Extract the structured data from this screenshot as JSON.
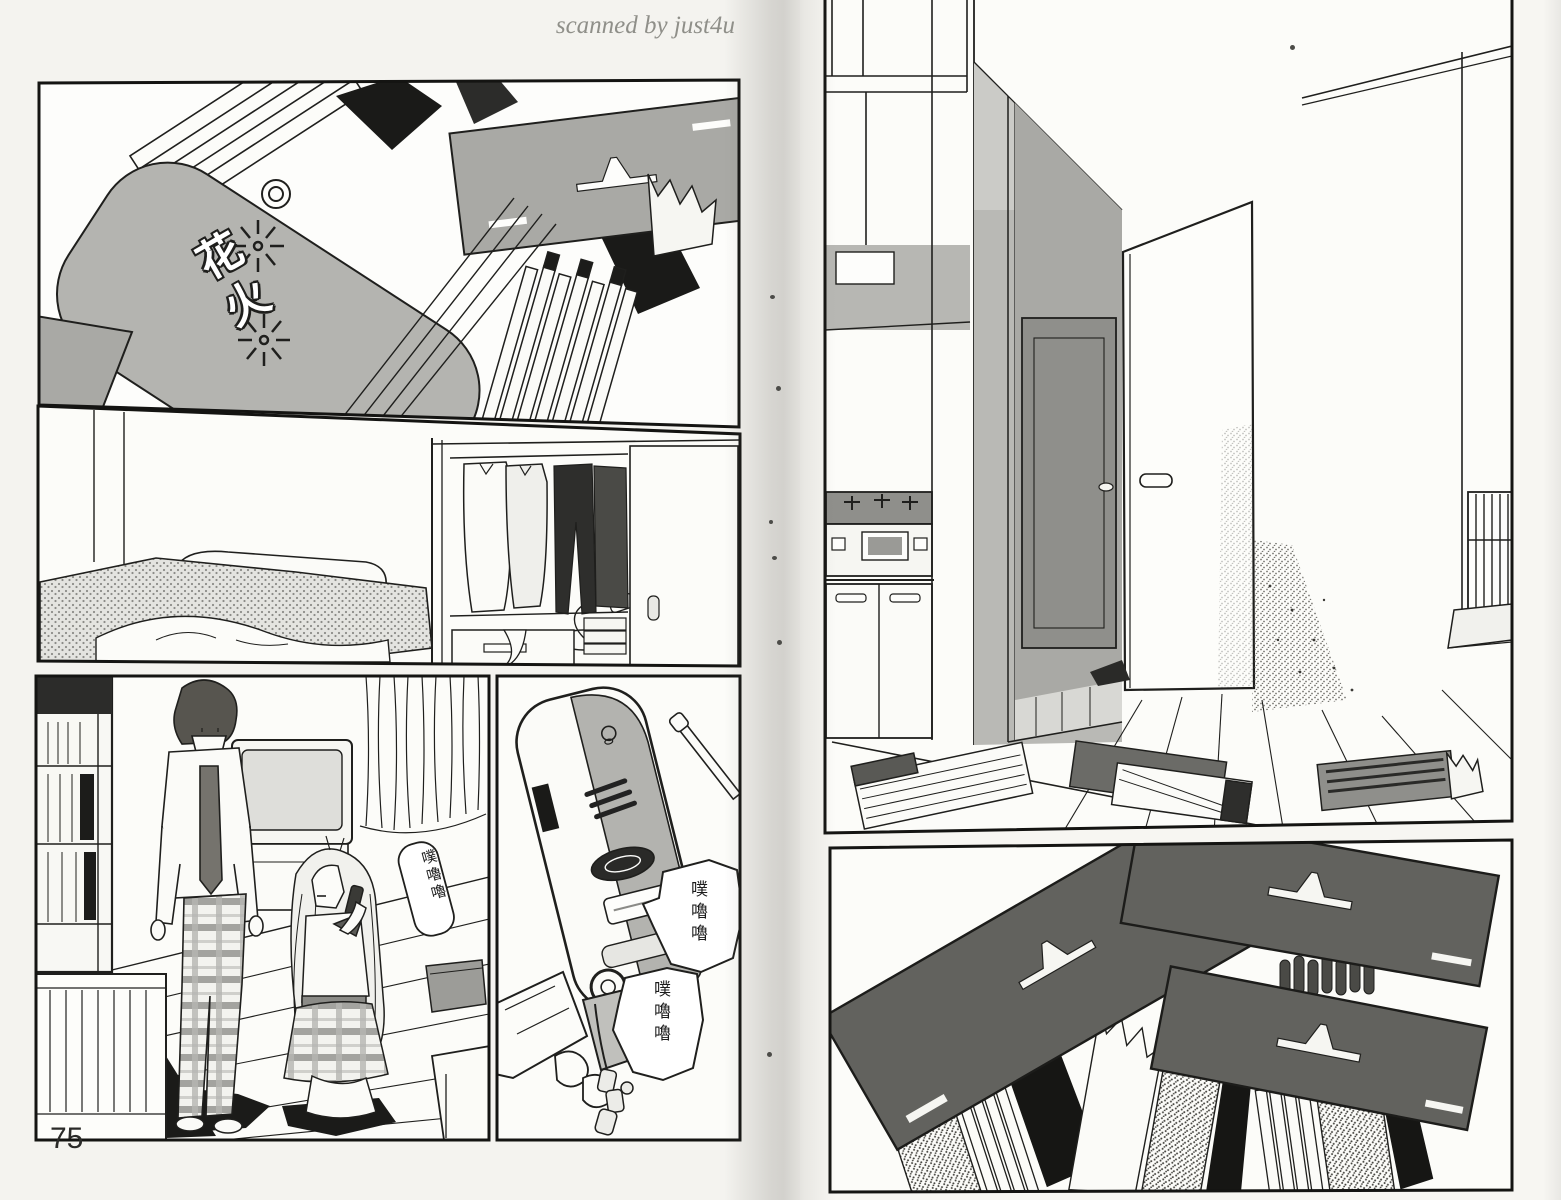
{
  "watermark": "scanned by just4u",
  "page_number": "75",
  "art_text": {
    "fireworks_logo": "花火",
    "sfx_room": "噗嚕嚕",
    "sfx_phone_1": "噗嚕嚕",
    "sfx_phone_2": "噗嚕嚕"
  },
  "colors": {
    "paper": "#f4f3ef",
    "ink": "#1f1f1d",
    "halftone_gray": "#b4b4b0",
    "dark_card_gray": "#62625e",
    "gutter_shadow": "#cfcec9",
    "watermark_gray": "#8f8f89"
  }
}
